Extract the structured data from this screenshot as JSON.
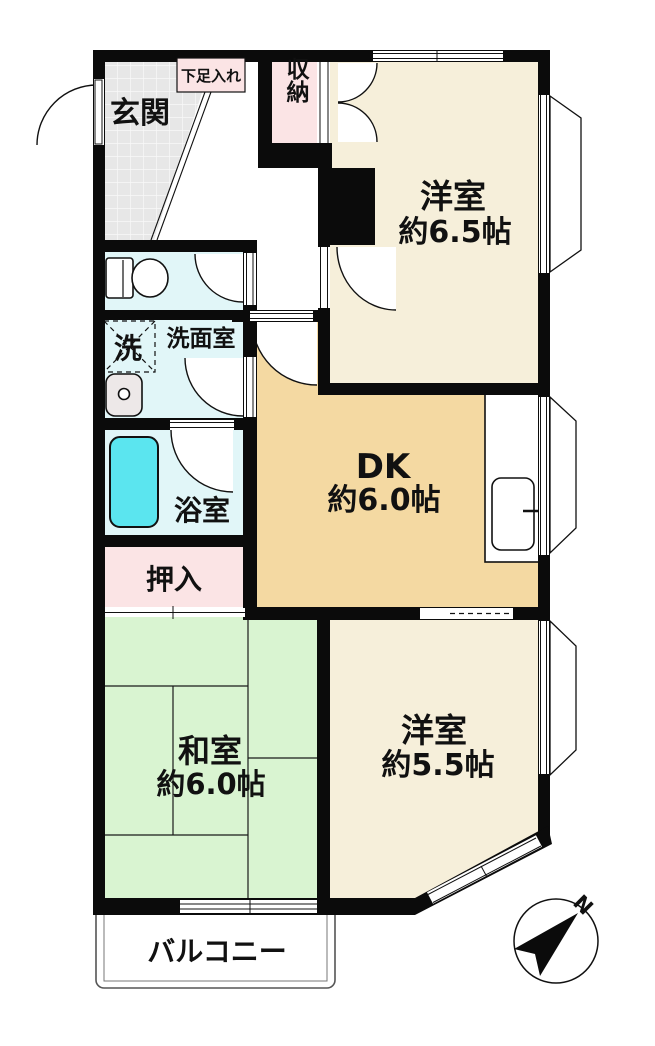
{
  "floorplan": {
    "type": "apartment-floor-plan",
    "rooms": {
      "genkan": {
        "label": "玄関"
      },
      "shoe_cabinet": {
        "label": "下足入れ"
      },
      "storage": {
        "label": "収納"
      },
      "western_65": {
        "label": "洋室",
        "size": "約6.5帖"
      },
      "washer": {
        "label": "洗"
      },
      "washroom": {
        "label": "洗面室"
      },
      "bathroom": {
        "label": "浴室"
      },
      "dk": {
        "label": "DK",
        "size": "約6.0帖"
      },
      "oshiire": {
        "label": "押入"
      },
      "japanese_60": {
        "label": "和室",
        "size": "約6.0帖"
      },
      "western_55": {
        "label": "洋室",
        "size": "約5.5帖"
      },
      "balcony": {
        "label": "バルコニー"
      }
    },
    "compass": {
      "north_label": "N"
    },
    "colors": {
      "wall": "#0b0b0b",
      "western_room": "#F6EFDA",
      "dk": "#F4D9A2",
      "japanese_room": "#D9F4D1",
      "wet_area": "#E1F6F8",
      "bathtub": "#5BE5EF",
      "closet_pink": "#FBE4E5",
      "entrance_tile": "#E7E7E7"
    }
  }
}
